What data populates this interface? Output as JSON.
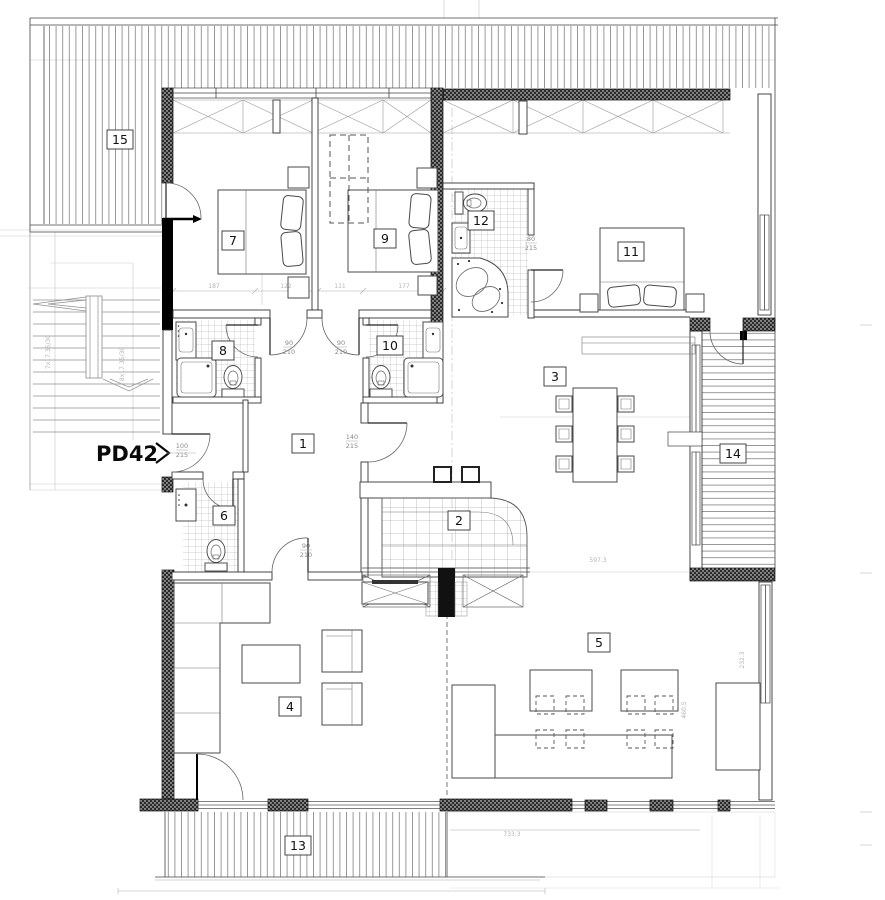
{
  "plan": {
    "code": "PD42"
  },
  "rooms": {
    "r1": "1",
    "r2": "2",
    "r3": "3",
    "r4": "4",
    "r5": "5",
    "r6": "6",
    "r7": "7",
    "r8": "8",
    "r9": "9",
    "r10": "10",
    "r11": "11",
    "r12": "12",
    "r13": "13",
    "r14": "14",
    "r15": "15"
  },
  "dims": {
    "n90": "90",
    "n210": "210",
    "n80": "80",
    "n215": "215",
    "n140": "140",
    "n100": "100",
    "s187": "187",
    "s122": "122",
    "s111": "111",
    "s177": "177",
    "w597": "597.3",
    "total_bottom": "733.3",
    "s232": "232.3",
    "s460": "460.5",
    "stair_a": "7x17.35/30",
    "stair_b": "8x17.35/30"
  }
}
